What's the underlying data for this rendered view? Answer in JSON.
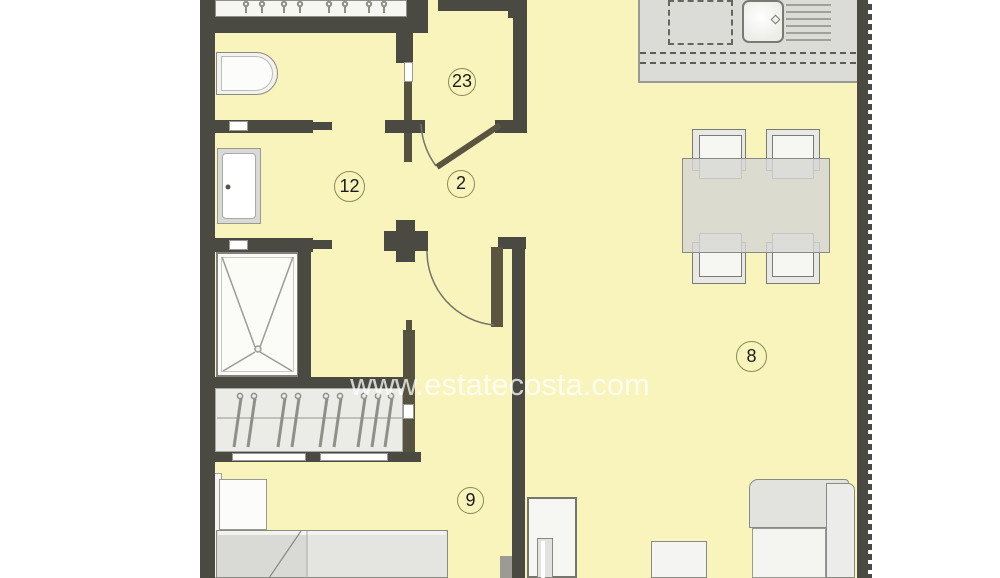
{
  "document": {
    "type": "apartment floor plan"
  },
  "watermark": {
    "text": "www.estatecosta.com"
  },
  "rooms": [
    {
      "label": "23"
    },
    {
      "label": "12"
    },
    {
      "label": "2"
    },
    {
      "label": "8"
    },
    {
      "label": "9"
    }
  ],
  "palette": {
    "floor": "#f8f4bc",
    "wall": "#4a4a42",
    "door_leaf": "#5a5440",
    "furniture_outline": "#8a8a84",
    "furniture_fill": "#f4f4f1",
    "counter_fill": "#dbdbd8",
    "label_ring": "#8a8a58",
    "watermark_color": "#ffffff"
  }
}
